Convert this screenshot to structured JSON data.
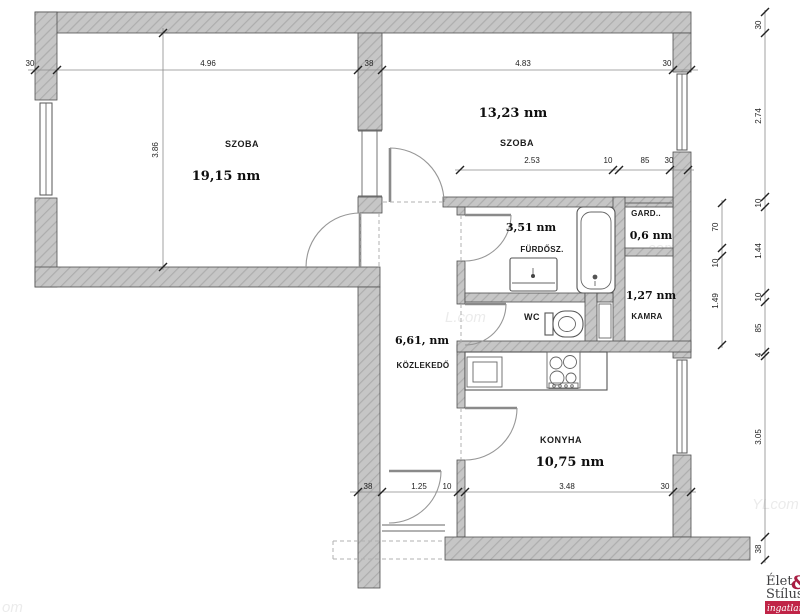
{
  "rooms": {
    "szoba1": {
      "name": "SZOBA",
      "area": "19,15 nm"
    },
    "szoba2": {
      "name": "SZOBA",
      "area": "13,23 nm"
    },
    "furdoszoba": {
      "name": "FÜRDŐSZ.",
      "area": "3,51 nm"
    },
    "gardrob": {
      "name": "GARD..",
      "area": "0,6 nm"
    },
    "kamra": {
      "name": "KAMRA",
      "area": "1,27 nm"
    },
    "wc": {
      "name": "WC"
    },
    "kozlekedo": {
      "name": "KÖZLEKEDŐ",
      "area": "6,61, nm"
    },
    "konyha": {
      "name": "KONYHA",
      "area": "10,75 nm"
    }
  },
  "dimensions": {
    "top": [
      "30",
      "4.96",
      "38",
      "4.83",
      "30"
    ],
    "room1_height": "3.86",
    "bath_chain": [
      "2.53",
      "10",
      "85",
      "30"
    ],
    "bottom": [
      "38",
      "1.25",
      "10",
      "3.48",
      "30"
    ],
    "inner_right": [
      "70",
      "10",
      "1.49"
    ],
    "outer_right": [
      "30",
      "2.74",
      "10",
      "1.44",
      "10",
      "85",
      "4",
      "3.05",
      "38"
    ]
  },
  "watermarks": [
    "L.com",
    "com",
    "YLcom",
    "om"
  ],
  "logo": {
    "line1_text": "Élet",
    "amp": "&",
    "line2_text": "Stílus",
    "badge": "ingatlan",
    "accent": "#c02447",
    "amp_color": "#a81d42",
    "text_color": "#3f3f41"
  }
}
